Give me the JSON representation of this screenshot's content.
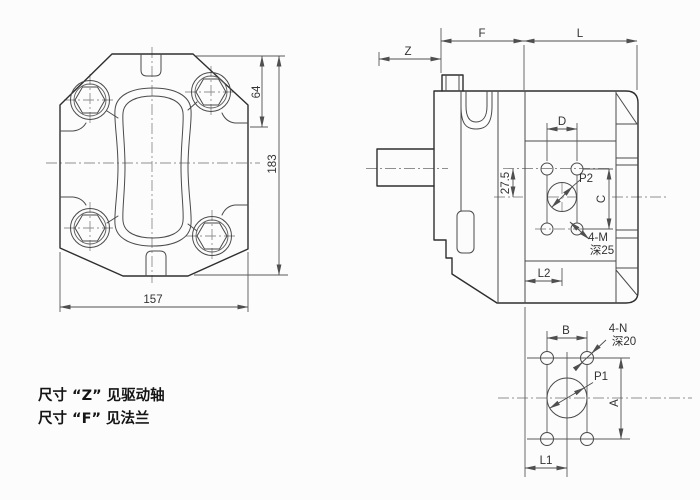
{
  "drawing_title": "gear-pump-dimensional-drawing",
  "front_view": {
    "dim_top_to_shoulder": "64",
    "dim_total_height": "183",
    "dim_width": "157"
  },
  "side_view": {
    "dim_shaft": "Z",
    "dim_flange": "F",
    "dim_body_length": "L",
    "dim_port_hole_spacing_x": "D",
    "dim_port_offset": "27.5",
    "port_label": "P2",
    "dim_port_hole_spacing_y": "C",
    "thread_callout_line1": "4-M",
    "thread_callout_line2": "深25",
    "dim_port_position": "L2"
  },
  "bottom_view": {
    "dim_port_hole_spacing_x": "B",
    "thread_callout_line1": "4-N",
    "thread_callout_line2": "深20",
    "port_label": "P1",
    "dim_port_hole_spacing_y": "A",
    "dim_port_position": "L1"
  },
  "notes": {
    "line1": "尺寸 “Z” 见驱动轴",
    "line2": "尺寸 “F” 见法兰"
  },
  "colors": {
    "background": "#fcfcfc",
    "outline": "#2e2e2e",
    "dimension": "#4f4f4f",
    "centerline": "#8f8f8f",
    "text": "#333333"
  }
}
